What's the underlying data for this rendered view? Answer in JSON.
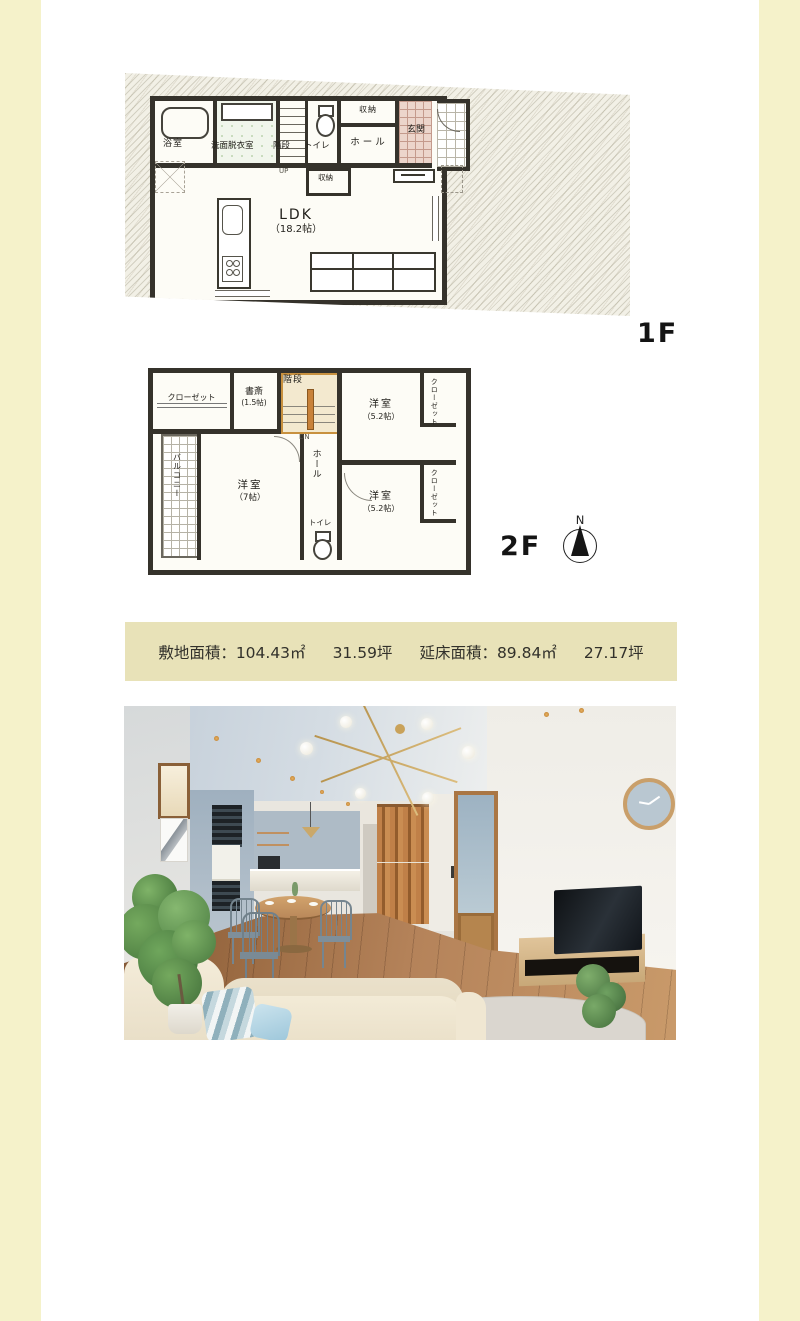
{
  "colors": {
    "side_strip": "#f5f2ca",
    "banner_bg": "#e8e2b8",
    "plan_wall": "#35322b",
    "plan_paper": "#fdfcf6",
    "entrance_tile": "#ecd5cb",
    "stair_accent": "#c8913f"
  },
  "floor1": {
    "label": "1F",
    "rooms": {
      "bath": "浴室",
      "washroom": "洗面脱衣室",
      "stairs": "階段",
      "toilet": "トイレ",
      "storage_top": "収納",
      "hall": "ホール",
      "entrance": "玄関",
      "storage_mid": "収納",
      "up": "UP",
      "ldk_name": "LDK",
      "ldk_size": "（18.2帖）"
    }
  },
  "floor2": {
    "label": "2F",
    "compass_n": "N",
    "rooms": {
      "closet_tl": "クローゼット",
      "study_name": "書斎",
      "study_size": "(1.5帖)",
      "stairs": "階段",
      "down": "DN",
      "bedroom_tr_name": "洋室",
      "bedroom_tr_size": "（5.2帖）",
      "closet_tr": "クローゼット",
      "balcony": "バルコニー",
      "bedroom_left_name": "洋室",
      "bedroom_left_size": "（7帖）",
      "hall": "ホール",
      "toilet": "トイレ",
      "bedroom_br_name": "洋室",
      "bedroom_br_size": "（5.2帖）",
      "closet_br": "クローゼット"
    }
  },
  "banner": {
    "segments": [
      "敷地面積：104.43㎡",
      "31.59坪",
      "延床面積：89.84㎡",
      "27.17坪"
    ]
  }
}
